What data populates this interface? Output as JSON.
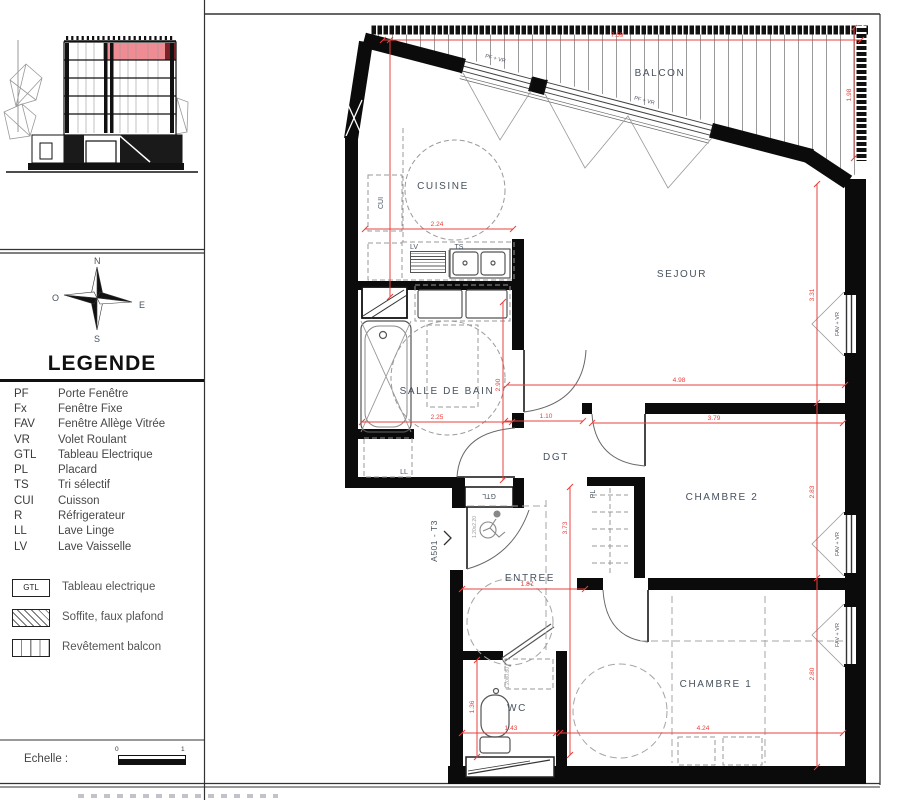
{
  "compass": {
    "n": "N",
    "e": "E",
    "s": "S",
    "o": "O"
  },
  "legend": {
    "title": "LEGENDE",
    "items": [
      {
        "abbr": "PF",
        "label": "Porte Fenêtre"
      },
      {
        "abbr": "Fx",
        "label": "Fenêtre Fixe"
      },
      {
        "abbr": "FAV",
        "label": "Fenêtre Allège Vitrée"
      },
      {
        "abbr": "VR",
        "label": "Volet Roulant"
      },
      {
        "abbr": "GTL",
        "label": "Tableau Electrique"
      },
      {
        "abbr": "PL",
        "label": "Placard"
      },
      {
        "abbr": "TS",
        "label": "Tri sélectif"
      },
      {
        "abbr": "CUI",
        "label": "Cuisson"
      },
      {
        "abbr": "R",
        "label": "Réfrigerateur"
      },
      {
        "abbr": "LL",
        "label": "Lave Linge"
      },
      {
        "abbr": "LV",
        "label": "Lave Vaisselle"
      }
    ],
    "swatches": [
      {
        "box": "GTL",
        "label": "Tableau electrique"
      },
      {
        "box": "",
        "label": "Soffite, faux plafond"
      },
      {
        "box": "",
        "label": "Revêtement balcon"
      }
    ],
    "scale": {
      "label": "Echelle :",
      "tick0": "0",
      "tick1": "1"
    }
  },
  "plan": {
    "unit": "A501 - T3",
    "rooms": {
      "balcon": "BALCON",
      "cuisine": "CUISINE",
      "sejour": "SEJOUR",
      "sdb": "SALLE DE BAIN",
      "dgt": "DGT",
      "chambre2": "CHAMBRE 2",
      "entree": "ENTREE",
      "chambre1": "CHAMBRE 1",
      "wc": "WC"
    },
    "tags": {
      "lv": "LV",
      "ts": "TS",
      "cui": "CUI",
      "ll": "LL",
      "pl": "PL",
      "gtl": "GTL"
    },
    "windows": {
      "pf1": "PF + VR",
      "pf2": "PF + VR",
      "fav_sejour": "FAV + VR",
      "fav_ch2": "FAV + VR",
      "fav_ch1": "FAV + VR"
    },
    "small": {
      "entry_clear": "1.20x2.20",
      "wc_clear": "1.20x0.80"
    },
    "dims": {
      "balcon_w": "7.59",
      "balcon_d": "1.98",
      "cuisine_w": "2.24",
      "sejour_w": "4.98",
      "sejour_d": "3.31",
      "sdb_w": "2.25",
      "sdb_d": "2.90",
      "dgt_w": "1.10",
      "ch2_w": "3.79",
      "ch2_d": "2.83",
      "hall_d": "3.73",
      "entree_w": "1.87",
      "ch1_w": "4.24",
      "ch1_d": "2.80",
      "wc_d": "1.36",
      "wc_w": "1.43"
    }
  },
  "colors": {
    "wall": "#0b0b0b",
    "dim_red": "#e8403c",
    "label_blue": "#47525e",
    "highlight": "#ef8b93",
    "highlight_dark": "#7e2028"
  }
}
